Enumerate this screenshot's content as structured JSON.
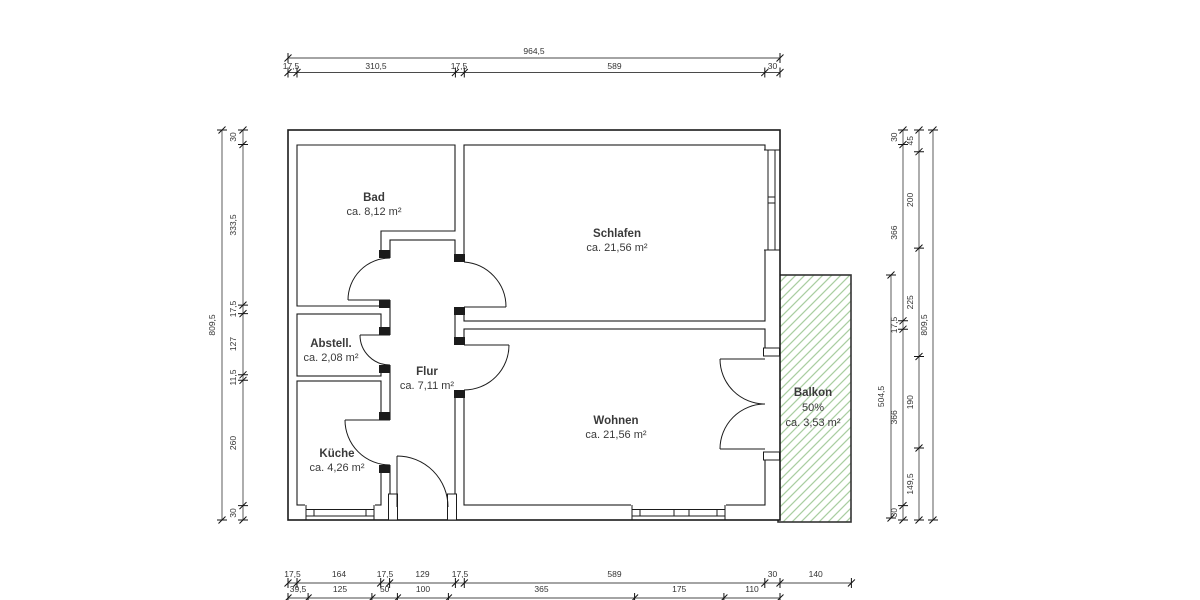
{
  "rooms": {
    "bad": {
      "name": "Bad",
      "area": "ca. 8,12 m²"
    },
    "schlafen": {
      "name": "Schlafen",
      "area": "ca. 21,56 m²"
    },
    "abstell": {
      "name": "Abstell.",
      "area": "ca. 2,08 m²"
    },
    "flur": {
      "name": "Flur",
      "area": "ca. 7,11 m²"
    },
    "kueche": {
      "name": "Küche",
      "area": "ca. 4,26 m²"
    },
    "wohnen": {
      "name": "Wohnen",
      "area": "ca. 21,56 m²"
    },
    "balkon": {
      "name": "Balkon",
      "share": "50%",
      "area": "ca. 3,53 m²"
    }
  },
  "dims": {
    "top_total": "964,5",
    "top": [
      "17,5",
      "310,5",
      "17,5",
      "589",
      "30"
    ],
    "left_total": "809,5",
    "left": [
      "30",
      "333,5",
      "17,5",
      "127",
      "11,5",
      "260",
      "30"
    ],
    "right_total": "809,5",
    "balkon_height": "504,5",
    "right_inner": [
      "30",
      "366",
      "17,5",
      "366",
      "30"
    ],
    "right_outer": [
      "45",
      "200",
      "225",
      "190",
      "149,5"
    ],
    "bottom_walls": [
      "17,5",
      "164",
      "17,5",
      "129",
      "17,5",
      "589",
      "30",
      "140"
    ],
    "bottom_openings": [
      "39,5",
      "125",
      "50",
      "100",
      "365",
      "175",
      "110"
    ]
  },
  "colors": {
    "hatch": "#a8cda1",
    "wall": "#1b1b1b",
    "dim": "#4a4a4a"
  }
}
